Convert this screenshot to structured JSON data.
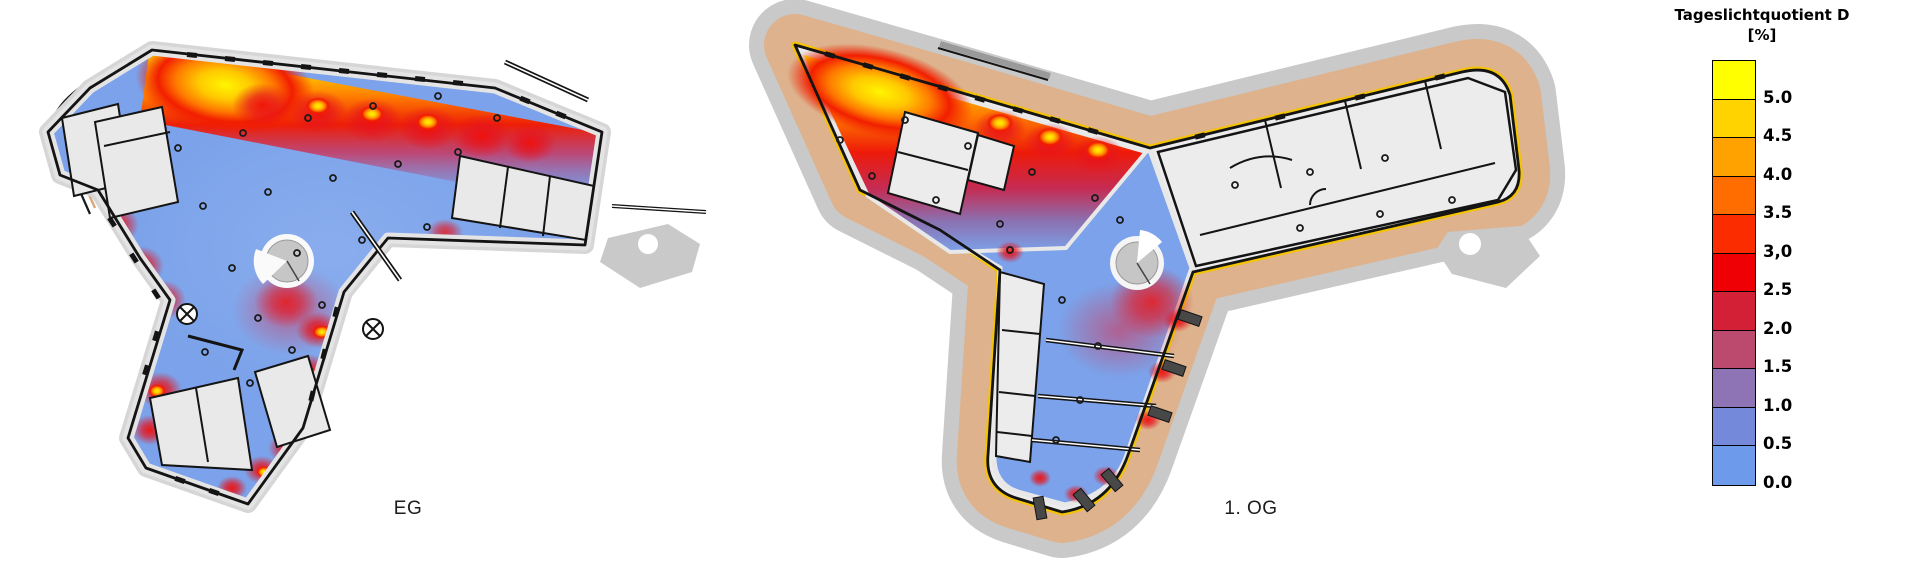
{
  "page": {
    "background": "#FFFFFF"
  },
  "plans": [
    {
      "id": "eg",
      "label": "EG"
    },
    {
      "id": "og",
      "label": "1. OG"
    }
  ],
  "legend": {
    "title": "Tageslichtquotient D",
    "unit": "[%]",
    "entries": [
      {
        "label": "5.0",
        "color": "#FFFF00"
      },
      {
        "label": "4.5",
        "color": "#FFD300"
      },
      {
        "label": "4.0",
        "color": "#FFA200"
      },
      {
        "label": "3.5",
        "color": "#FF6D00"
      },
      {
        "label": "3,0",
        "color": "#FB2D00"
      },
      {
        "label": "2.5",
        "color": "#EE0005"
      },
      {
        "label": "2.0",
        "color": "#D32036"
      },
      {
        "label": "1.5",
        "color": "#BC4A6E"
      },
      {
        "label": "1.0",
        "color": "#8E74B5"
      },
      {
        "label": "0.5",
        "color": "#7489D9"
      },
      {
        "label": "0.0",
        "color": "#6D9AEA"
      }
    ]
  },
  "chart_data": {
    "type": "heatmap",
    "title": "Tageslichtquotient D",
    "unit": "%",
    "value_range": [
      0.0,
      5.0
    ],
    "bin_step": 0.5,
    "legend_position": "right",
    "scale_bins": [
      {
        "label": "5.0",
        "color": "#FFFF00"
      },
      {
        "label": "4.5",
        "color": "#FFD300"
      },
      {
        "label": "4.0",
        "color": "#FFA200"
      },
      {
        "label": "3.5",
        "color": "#FF6D00"
      },
      {
        "label": "3,0",
        "color": "#FB2D00"
      },
      {
        "label": "2.5",
        "color": "#EE0005"
      },
      {
        "label": "2.0",
        "color": "#D32036"
      },
      {
        "label": "1.5",
        "color": "#BC4A6E"
      },
      {
        "label": "1.0",
        "color": "#8E74B5"
      },
      {
        "label": "0.5",
        "color": "#7489D9"
      },
      {
        "label": "0.0",
        "color": "#6D9AEA"
      }
    ],
    "panels": [
      {
        "label": "EG",
        "note": "Ground floor daylight-factor map: 3-5%+ (yellow/red) along the north-west facade glazing and window bays, dropping to 0-1% (blue) in the interior; grey service cores unrated."
      },
      {
        "label": "1. OG",
        "note": "Upper floor daylight-factor map with surrounding terrace band: 3-5%+ along the top facade of the NW wing, 0-0.5% in corridors and inner rooms; east wing rooms unrated (grey)."
      }
    ],
    "measurement_points": {
      "eg": [
        [
          178,
          148
        ],
        [
          243,
          133
        ],
        [
          308,
          118
        ],
        [
          373,
          106
        ],
        [
          438,
          96
        ],
        [
          497,
          118
        ],
        [
          203,
          206
        ],
        [
          268,
          192
        ],
        [
          333,
          178
        ],
        [
          398,
          164
        ],
        [
          458,
          152
        ],
        [
          232,
          268
        ],
        [
          297,
          253
        ],
        [
          362,
          240
        ],
        [
          427,
          227
        ],
        [
          258,
          318
        ],
        [
          322,
          305
        ],
        [
          292,
          350
        ],
        [
          250,
          383
        ],
        [
          205,
          352
        ]
      ],
      "og": [
        [
          840,
          140
        ],
        [
          905,
          120
        ],
        [
          968,
          146
        ],
        [
          1032,
          172
        ],
        [
          1095,
          198
        ],
        [
          872,
          176
        ],
        [
          936,
          200
        ],
        [
          1000,
          224
        ],
        [
          1120,
          220
        ],
        [
          1062,
          300
        ],
        [
          1098,
          346
        ],
        [
          1080,
          400
        ],
        [
          1056,
          440
        ],
        [
          1235,
          185
        ],
        [
          1310,
          172
        ],
        [
          1385,
          158
        ],
        [
          1300,
          228
        ],
        [
          1380,
          214
        ],
        [
          1452,
          200
        ],
        [
          1010,
          250
        ]
      ]
    }
  }
}
